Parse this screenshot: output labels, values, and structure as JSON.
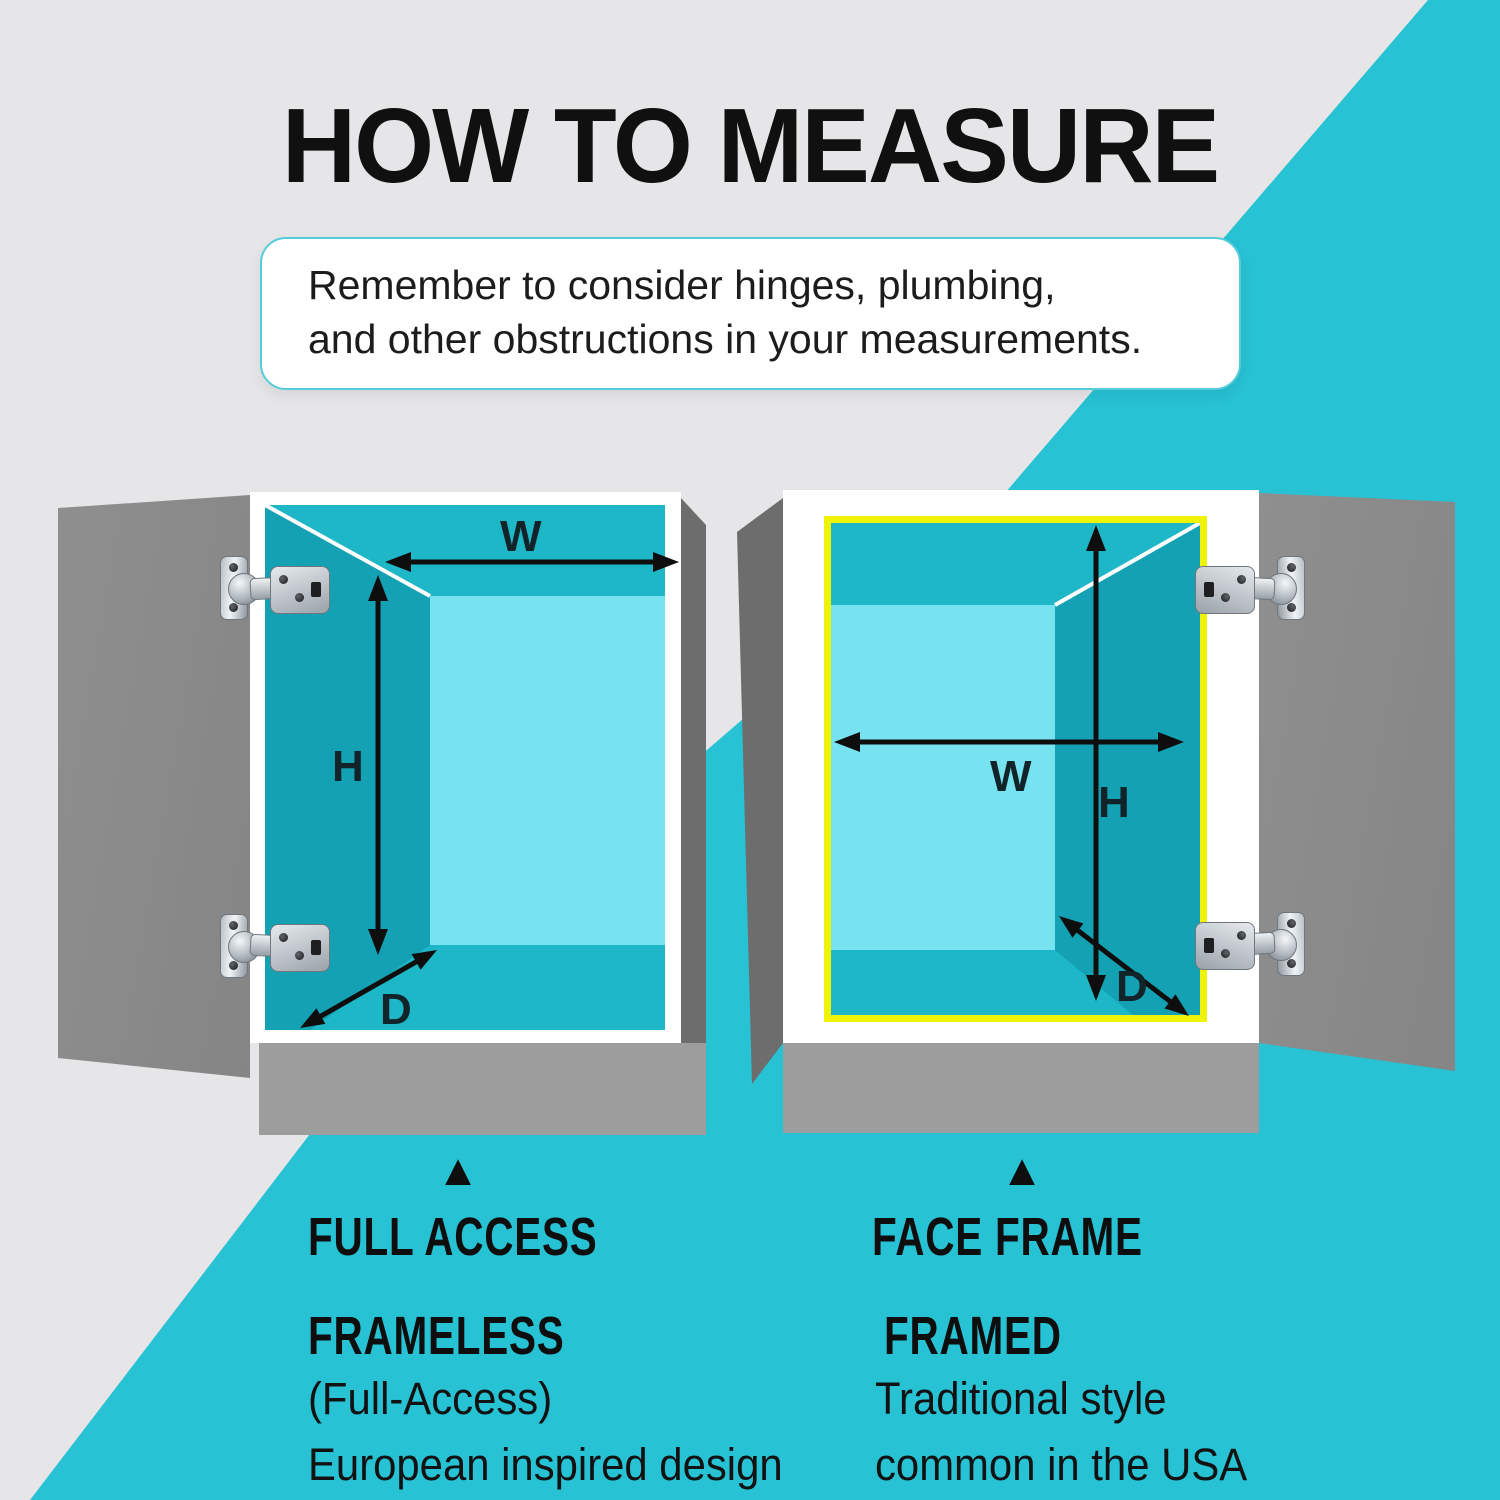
{
  "title": "HOW TO MEASURE",
  "note": {
    "line1": "Remember to consider hinges, plumbing,",
    "line2": "and other obstructions in your measurements."
  },
  "colors": {
    "background_gray": "#e6e6e8",
    "accent_cyan": "#27c2d4",
    "interior_wall_teal": "#14a1b3",
    "interior_mid_teal": "#1eb7c7",
    "back_panel_light_cyan": "#77e3f0",
    "door_gray": "#8a8a8a",
    "side_panel_gray": "#6d6d6d",
    "base_gray": "#9d9d9d",
    "face_frame_yellow": "#eef307",
    "text_black": "#101010"
  },
  "cabinets": {
    "left": {
      "width_label": "W",
      "height_label": "H",
      "depth_label": "D",
      "marker": "▲",
      "heading": "FULL ACCESS",
      "subheading": "FRAMELESS",
      "caption_line1": "(Full-Access)",
      "caption_line2": "European inspired design"
    },
    "right": {
      "width_label": "W",
      "height_label": "H",
      "depth_label": "D",
      "marker": "▲",
      "heading": "FACE FRAME",
      "subheading": "FRAMED",
      "caption_line1": "Traditional style",
      "caption_line2": "common in the USA"
    }
  }
}
